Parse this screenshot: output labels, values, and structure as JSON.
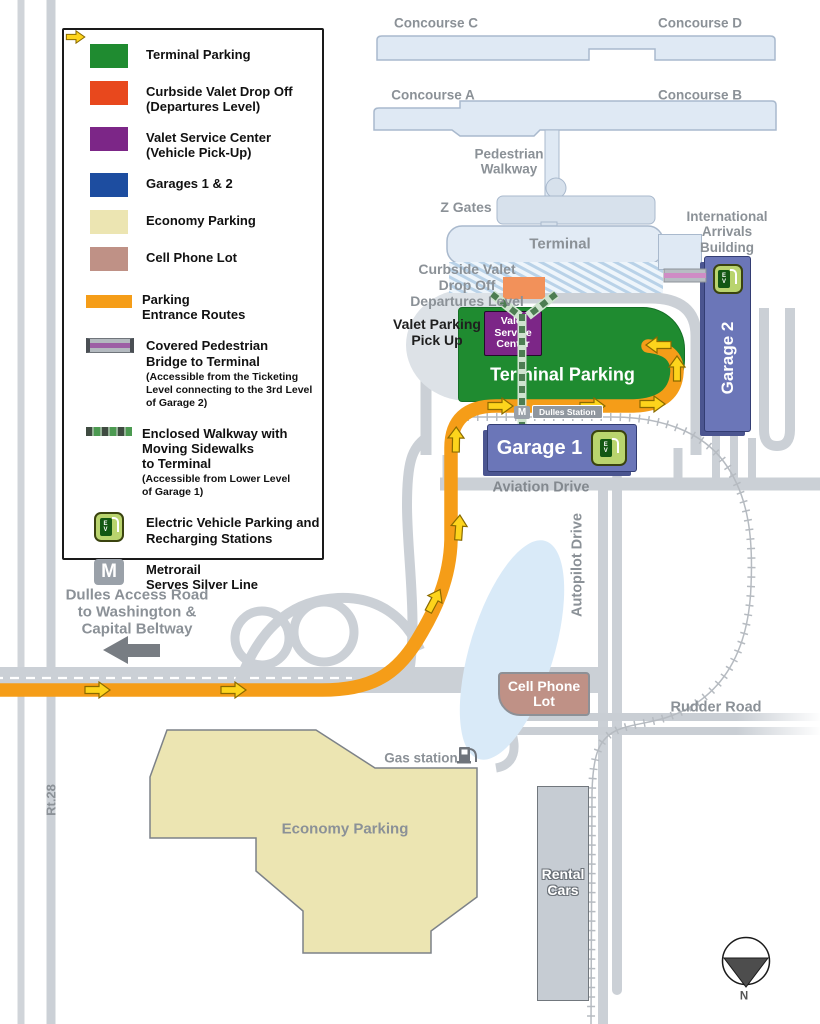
{
  "legend": {
    "items": [
      {
        "label": "Terminal Parking"
      },
      {
        "label": "Curbside Valet Drop Off\n(Departures Level)"
      },
      {
        "label": "Valet Service Center\n(Vehicle Pick-Up)"
      },
      {
        "label": "Garages 1 & 2"
      },
      {
        "label": "Economy Parking"
      },
      {
        "label": "Cell Phone Lot"
      },
      {
        "label": "Parking\nEntrance Routes"
      },
      {
        "label": "Covered Pedestrian\nBridge to Terminal",
        "note": "(Accessible from the Ticketing\nLevel connecting to the 3rd Level\nof Garage 2)"
      },
      {
        "label": "Enclosed Walkway with\nMoving Sidewalks\nto Terminal",
        "note": "(Accessible from Lower Level\nof Garage 1)"
      },
      {
        "label": "Electric Vehicle Parking and\nRecharging Stations"
      },
      {
        "label": "Metrorail\nServes Silver Line"
      }
    ]
  },
  "map": {
    "concourses": {
      "c": "Concourse C",
      "d": "Concourse D",
      "a": "Concourse A",
      "b": "Concourse B"
    },
    "labels": {
      "pedestrian_walkway": "Pedestrian\nWalkway",
      "z_gates": "Z Gates",
      "terminal": "Terminal",
      "international_arrivals": "International\nArrivals\nBuilding",
      "curbside_valet": "Curbside Valet\nDrop Off\nDepartures Level",
      "valet_parking_pickup": "Valet Parking\nPick Up",
      "valet_service_center": "Valet\nService\nCenter",
      "terminal_parking": "Terminal Parking",
      "garage1": "Garage 1",
      "garage2": "Garage 2",
      "dulles_station": "Dulles Station",
      "aviation_drive": "Aviation Drive",
      "autopilot_drive": "Autopilot Drive",
      "rudder_road": "Rudder Road",
      "rt28": "Rt.28",
      "cell_phone_lot": "Cell Phone\nLot",
      "economy_parking": "Economy Parking",
      "gas_station": "Gas station",
      "rental_cars": "Rental\nCars",
      "dulles_access": "Dulles Access Road\nto Washington &\nCapital Beltway",
      "metro_m": "M",
      "ev": "E\nV",
      "compass_n": "N"
    },
    "colors": {
      "terminal_parking_green": "#1f8b30",
      "curbside_valet_orange": "#e8481d",
      "valet_center_purple": "#7c2687",
      "garages_legend_blue": "#1d4da0",
      "garage_box_blue": "#6b76b8",
      "economy_yellow": "#ece5b2",
      "cell_lot_mauve": "#bf9186",
      "route_orange": "#f59d18",
      "arrow_yellow": "#fdd41c",
      "road_gray": "#cbd0d6",
      "bridge_purple": "#9d5fa5",
      "walkway_green": "#4c9a51",
      "water_blue": "#d9eaf8"
    }
  }
}
